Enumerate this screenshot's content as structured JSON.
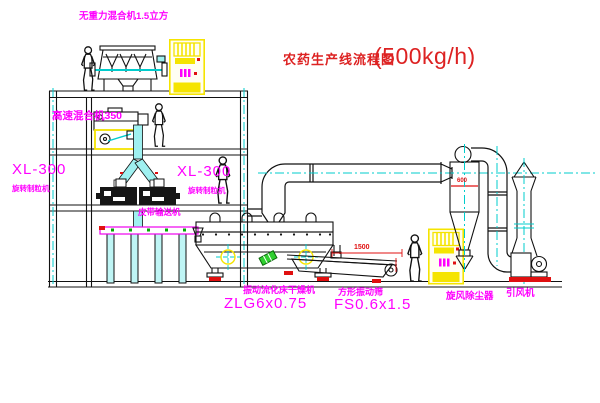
{
  "title": {
    "text": "农药生产线流程图",
    "capacity": "(500kg/h)"
  },
  "equipment_labels": {
    "gravity_mixer": "无重力混合机1.5立方",
    "high_speed_mixer": "高速混合机350",
    "granulator_left": {
      "model": "XL-300",
      "name": "旋转制粒机"
    },
    "granulator_mid": {
      "model": "XL-300",
      "name": "旋转制粒机"
    },
    "belt_conveyor": "皮带输送机",
    "fluid_bed_dryer": {
      "name": "振动流化床干燥机",
      "model": "ZLG6x0.75"
    },
    "vibrating_sieve": {
      "name": "方形振动筛",
      "model": "FS0.6x1.5"
    },
    "cyclone": "旋风除尘器",
    "induced_fan": "引风机"
  },
  "dimensions": {
    "sieve_length": "1500",
    "cyclone_dia": "600"
  },
  "colors": {
    "label_magenta": "#ff00ff",
    "title_red": "#dd2222",
    "dim_red": "#e01010",
    "highlight_yellow": "#f5e400",
    "duct_cyan": "#9ff0f0",
    "centerline_cyan": "#00cccc",
    "green": "#2fcf2f",
    "line_black": "#111111"
  }
}
